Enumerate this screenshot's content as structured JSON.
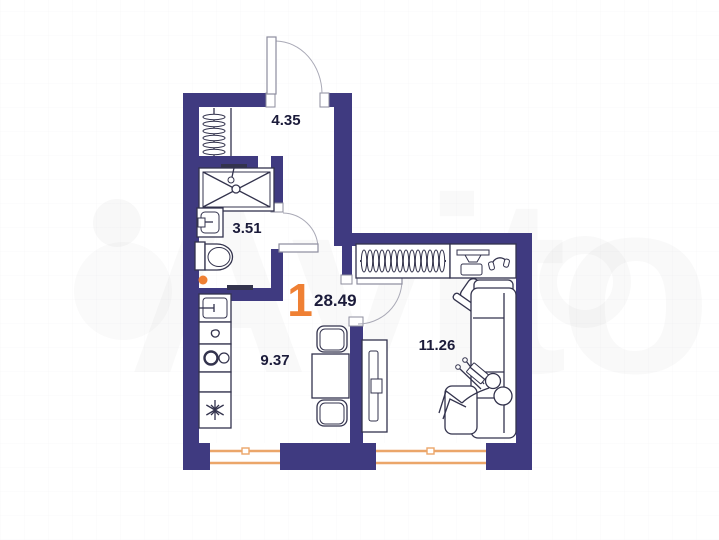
{
  "plan": {
    "watermark": "Avito",
    "total": {
      "room_count": "1",
      "area": "28.49"
    },
    "rooms": [
      {
        "id": "hallway",
        "area": "4.35"
      },
      {
        "id": "bathroom",
        "area": "3.51"
      },
      {
        "id": "kitchen",
        "area": "9.37"
      },
      {
        "id": "living-room",
        "area": "11.26"
      }
    ],
    "fixtures": [
      "entrance-door",
      "bathroom-door",
      "living-room-door",
      "hall-closet-hangers",
      "shower-tray",
      "washbasin",
      "toilet",
      "towel-rail",
      "kitchen-sink",
      "kitchen-counter",
      "cooktop",
      "fridge-snowflake",
      "dining-table",
      "chair",
      "tv-console",
      "wardrobe-hangers",
      "desk-with-monitor-and-headphones",
      "office-chair",
      "corner-sofa",
      "person-on-sofa",
      "window",
      "orange-marker-dot"
    ]
  },
  "colors": {
    "wall": "#3f3a80",
    "accent": "#ef8034",
    "ink": "#1b1b3a",
    "line": "#33334d",
    "window": "#eba66a"
  }
}
